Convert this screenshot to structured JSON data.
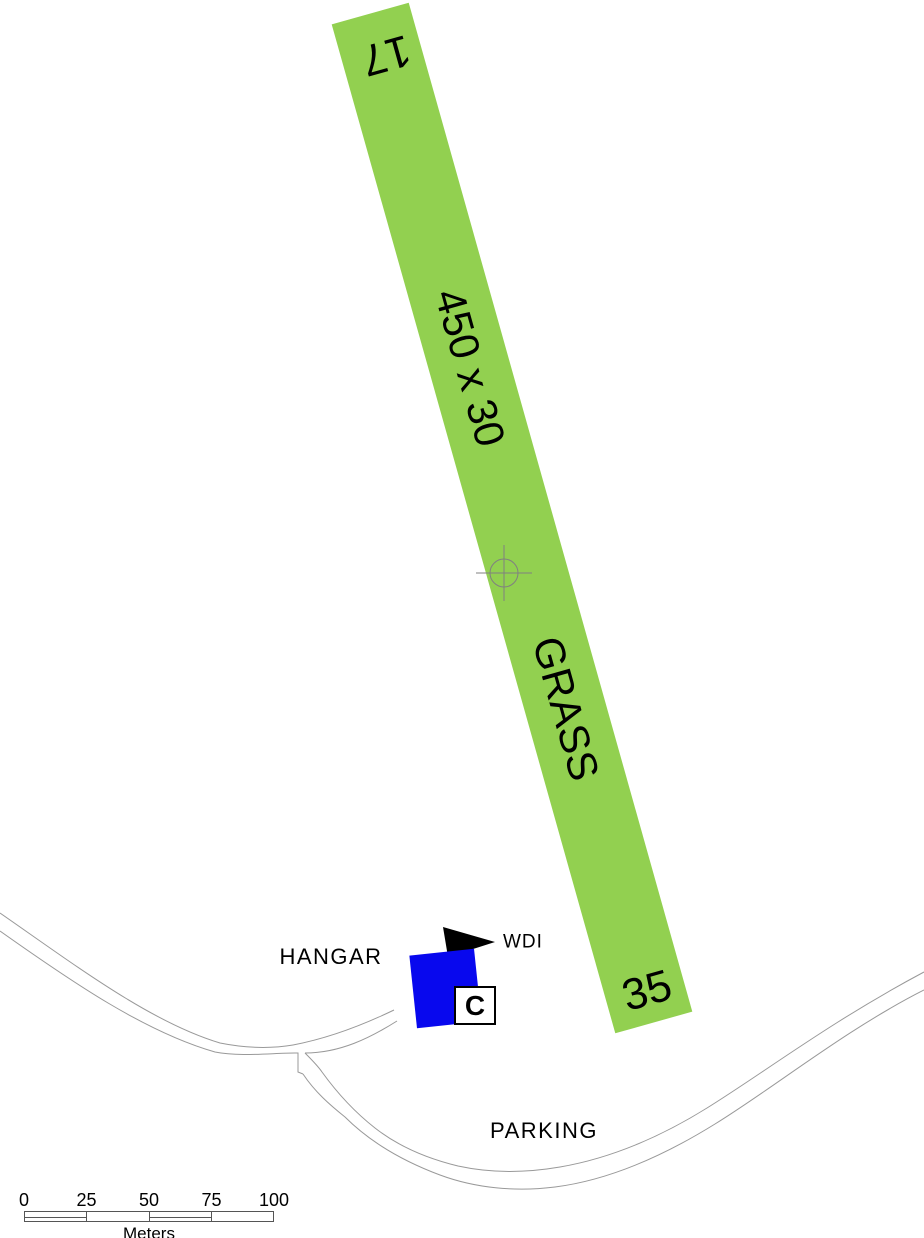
{
  "map": {
    "runway": {
      "number_top": "17",
      "number_bottom": "35",
      "dimensions": "450 x 30",
      "surface": "GRASS"
    },
    "buildings": {
      "hangar_label": "HANGAR"
    },
    "wind_indicator": {
      "label": "WDI"
    },
    "signage": {
      "c_marker": "C"
    },
    "areas": {
      "parking_label": "PARKING"
    },
    "scale_bar": {
      "tick_labels": [
        "0",
        "25",
        "50",
        "75",
        "100"
      ],
      "unit_label": "Meters"
    },
    "colors": {
      "runway_green": "#92D050",
      "hangar_blue": "#0808EE",
      "road_gray": "#999999",
      "crosshair_gray": "#808080",
      "ink": "#000000"
    }
  }
}
